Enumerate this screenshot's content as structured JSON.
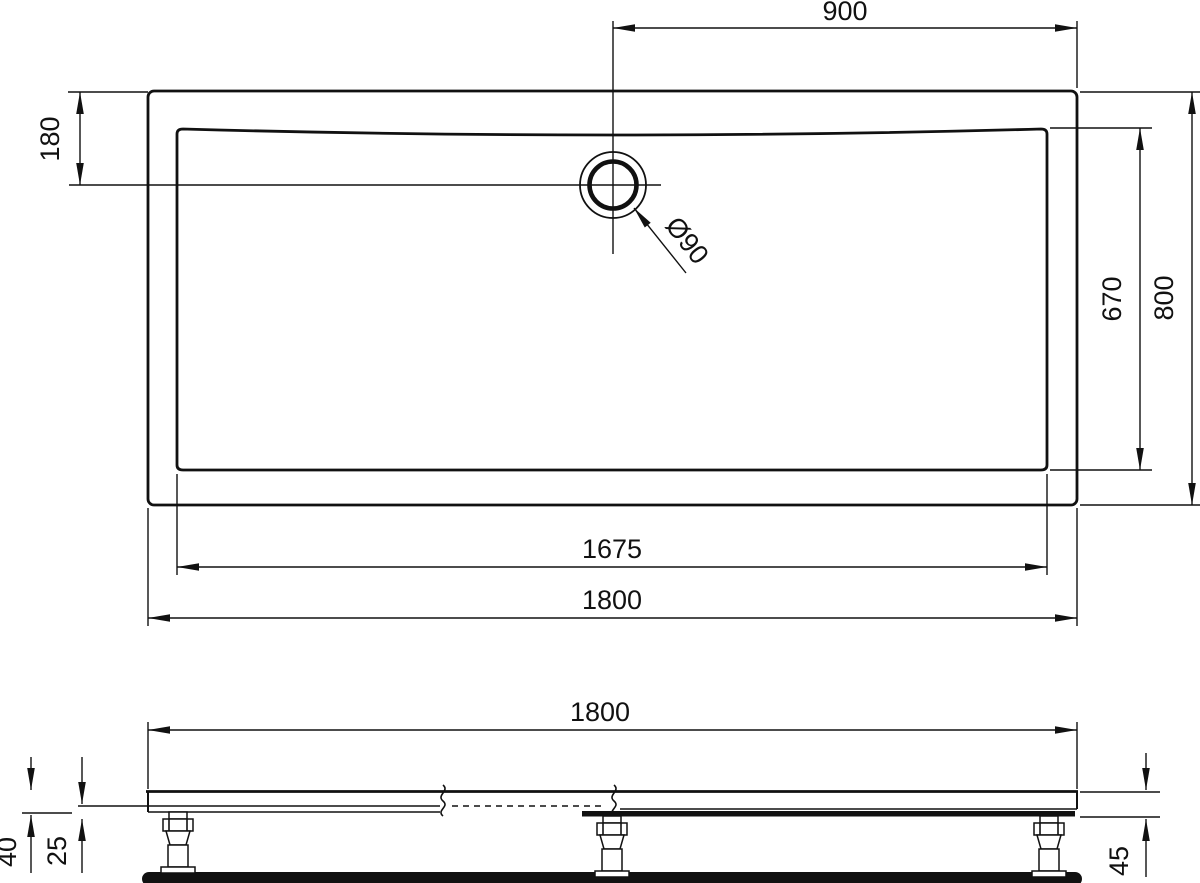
{
  "drawing": {
    "background": "#ffffff",
    "line_color": "#111111",
    "plan_view": {
      "dim_drain_offset_horizontal": "900",
      "dim_drain_offset_vertical": "180",
      "dim_basin_width": "670",
      "dim_overall_width": "800",
      "dim_basin_length": "1675",
      "dim_overall_length": "1800",
      "dim_drain_diameter": "Ø90"
    },
    "side_view": {
      "dim_overall_length": "1800",
      "dim_edge_height": "40",
      "dim_base_height": "25",
      "dim_total_height": "45"
    }
  }
}
